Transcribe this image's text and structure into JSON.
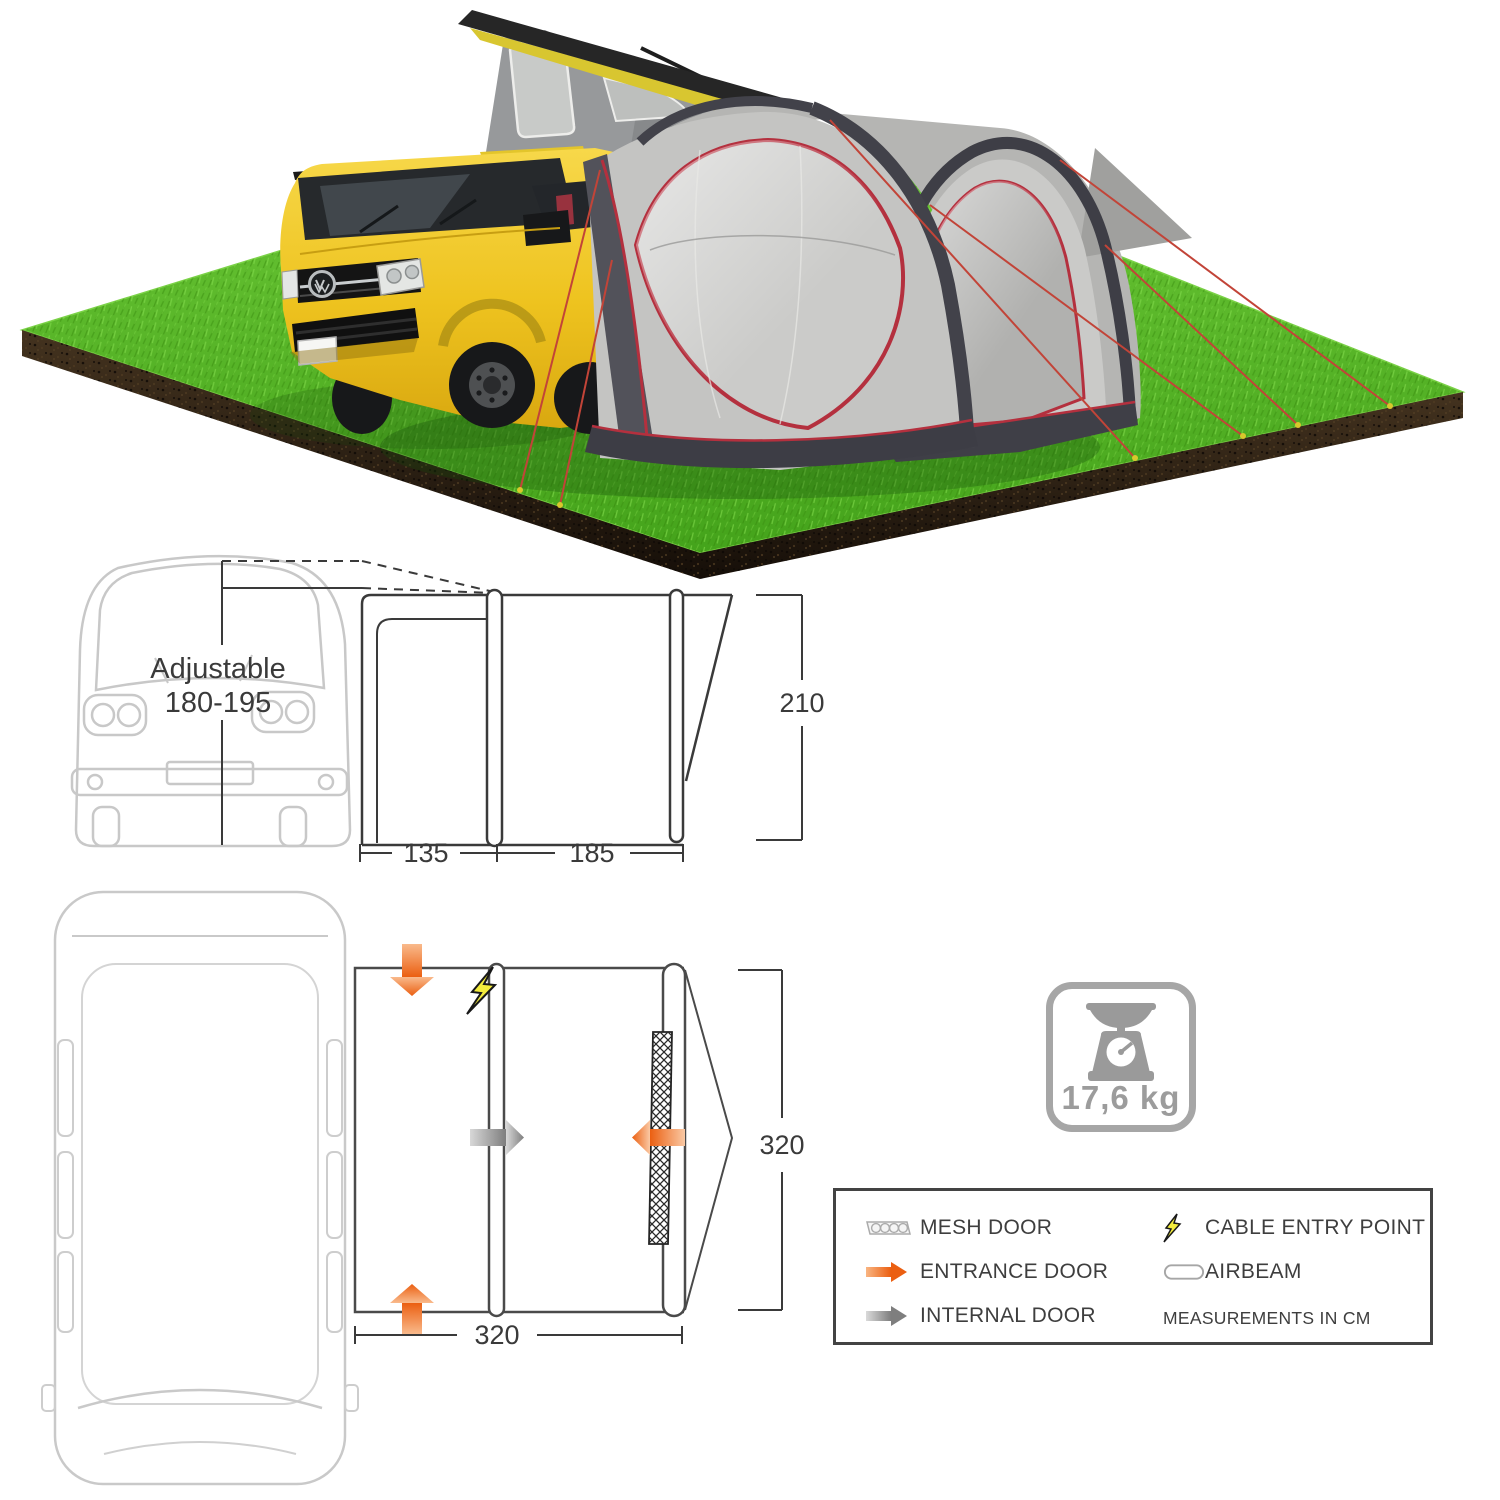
{
  "side_elevation": {
    "van_label_line1": "Adjustable",
    "van_label_line2": "180-195",
    "width_left": "135",
    "width_right": "185",
    "height": "210"
  },
  "floor_plan": {
    "width": "320",
    "depth": "320"
  },
  "weight": {
    "value": "17,6 kg",
    "icon": "kitchen-scale-icon"
  },
  "legend": {
    "left": [
      {
        "icon": "mesh-door-icon",
        "label": "MESH DOOR"
      },
      {
        "icon": "entrance-door-arrow-icon",
        "label": "ENTRANCE DOOR"
      },
      {
        "icon": "internal-door-arrow-icon",
        "label": "INTERNAL DOOR"
      }
    ],
    "right": [
      {
        "icon": "cable-entry-lightning-icon",
        "label": "CABLE ENTRY POINT"
      },
      {
        "icon": "airbeam-tube-icon",
        "label": "AIRBEAM"
      }
    ],
    "note": "MEASUREMENTS IN CM"
  },
  "colors": {
    "grass_green": "#55B82C",
    "soil_brown": "#2A1E12",
    "van_yellow": "#EFC21F",
    "awning_light_grey": "#C7C7C5",
    "awning_dark_grey": "#45454D",
    "trim_red": "#B4303E",
    "arrow_orange": "#EB5F11",
    "arrow_grey": "#7E7E7E",
    "lightning_yellow": "#F3EC3D",
    "diagram_line": "#3A3A3A",
    "van_outline_light": "#C9C9C9",
    "badge_grey": "#9C9C9C"
  }
}
